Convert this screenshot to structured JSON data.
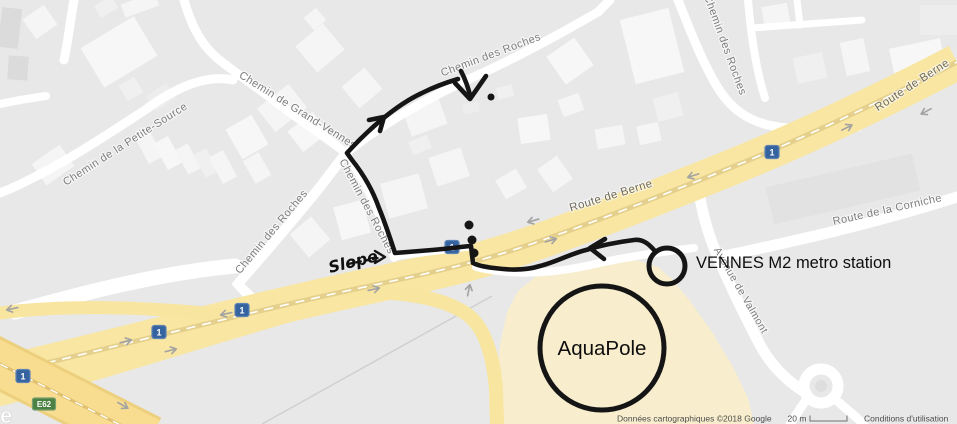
{
  "map": {
    "labels": {
      "petite_source": "Chemin de la Petite-Source",
      "grand_vennes": "Chemin de Grand-Vennes",
      "roches_top": "Chemin des Roches",
      "roches_right": "Chemin des Roches",
      "roches_left": "Chemin des Roches",
      "roches_center": "Chemin des Roches",
      "berne_center": "Route de Berne",
      "berne_topright": "Route de Berne",
      "corniche": "Route de la Corniche",
      "valmont": "Avenue de Valmont"
    },
    "shields": {
      "national_route": "1",
      "european_route": "E62"
    },
    "watermark_fragment": "e",
    "colors": {
      "major_road": "#f8e6a2",
      "motorway": "#f8dc8f",
      "minor_road": "#ffffff",
      "poi_area": "#f8edcd",
      "background": "#e8e8e8",
      "annotation_ink": "#151515",
      "shield_blue": "#35639f",
      "shield_green": "#4b8142"
    }
  },
  "annotations": {
    "station": "VENNES M2 metro station",
    "aquapole": "AquaPole",
    "slope": "Slope"
  },
  "attribution": {
    "map_data": "Données cartographiques ©2018 Google",
    "scale_label": "20 m",
    "terms": "Conditions d'utilisation"
  }
}
